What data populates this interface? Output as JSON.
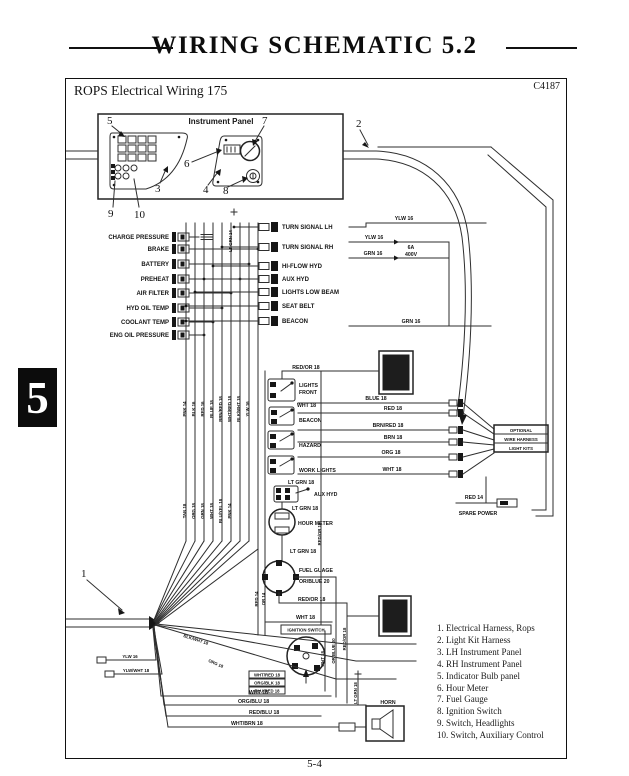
{
  "page": {
    "title": "WIRING SCHEMATIC 5.2",
    "chapter_tab": "5",
    "page_number": "5-4"
  },
  "header": {
    "subtitle": "ROPS Electrical Wiring 175",
    "code": "C4187"
  },
  "instrument_panel": {
    "label": "Instrument Panel"
  },
  "callouts": {
    "n1": "1",
    "n2": "2",
    "n3": "3",
    "n4": "4",
    "n5": "5",
    "n6": "6",
    "n7": "7",
    "n8": "8",
    "n9": "9",
    "n10": "10"
  },
  "indicators": [
    "CHARGE PRESSURE",
    "BRAKE",
    "BATTERY",
    "PREHEAT",
    "AIR FILTER",
    "HYD OIL TEMP",
    "COOLANT TEMP",
    "ENG OIL PRESSURE"
  ],
  "outputs": [
    "TURN SIGNAL LH",
    "TURN SIGNAL RH",
    "HI-FLOW HYD",
    "AUX HYD",
    "LIGHTS LOW BEAM",
    "SEAT BELT",
    "BEACON"
  ],
  "switches": {
    "lights1": "LIGHTS",
    "lights2": "FRONT",
    "beacon": "BEACON",
    "hazard": "HAZARD",
    "work_lights": "WORK LIGHTS",
    "aux_hyd": "AUX HYD"
  },
  "components": {
    "hour_meter": "HOUR METER",
    "fuel_gauge": "FUEL GUAGE",
    "ignition_switch": "IGNITION SWITCH",
    "horn": "HORN",
    "spare_power": "SPARE POWER",
    "fuse1": "6A",
    "fuse2": "400V",
    "optional1": "OPTIONAL",
    "optional2": "WIRE HARNESS",
    "optional3": "LIGHT KITS"
  },
  "wires": {
    "ylw16a": "YLW 16",
    "ylw16b": "YLW 16",
    "grn16a": "GRN 16",
    "grn16b": "GRN 16",
    "ltgrn14": "LT GRN 14",
    "redor18a": "RED/OR 18",
    "wht18a": "WHT 18",
    "blue18": "BLUE 18",
    "red18": "RED 18",
    "brnred18": "BRN/RED 18",
    "brn18": "BRN 18",
    "org18a": "ORG 18",
    "wht18b": "WHT 18",
    "ltgrn18a": "LT GRN 18",
    "ltgrn18b": "LT GRN 18",
    "ltgrn18c": "LT GRN 18",
    "orblue20a": "OR/BLUE 20",
    "redor18b": "RED/OR 18",
    "wht18c": "WHT 18",
    "redor18v": "RED/OR 18",
    "wht18v": "WHT 18",
    "orblue20v": "OR/BLUE 20",
    "redor18v2": "RED/OR 18",
    "ltgrn18v": "LT GRN 18",
    "red14a": "RED 14",
    "red14b": "RED 14",
    "or14": "OR 14",
    "wht18d": "WHT 18",
    "orgblu18": "ORG/BLU 18",
    "redblu18": "RED/BLU 18",
    "whtbrn18": "WHT/BRN 18",
    "ylw16c": "YLW 16",
    "ylwwht18": "YLW/WHT 18",
    "blkwht18": "BLK/WHT 18",
    "org18b": "ORG 18",
    "bundle_a": [
      "PNK 14",
      "BLK 16",
      "RED 16",
      "BLUE 18",
      "BRN/RED 18",
      "WHT/RED 18",
      "BLK/WHT 18",
      "YLW 16"
    ],
    "bundle_b": [
      "TAN 18",
      "ORG 18",
      "GRN 18",
      "WHT 18",
      "BLU/YEL 18",
      "PNK 14"
    ],
    "ign_stack": [
      "WHT/RED 18",
      "ORG/BLK 18",
      "BLU/RED 18"
    ]
  },
  "legend": {
    "items": [
      "1.  Electrical Harness,  Rops",
      "2.  Light Kit Harness",
      "3.  LH Instrument Panel",
      "4.  RH Instrument Panel",
      "5.  Indicator Bulb panel",
      "6.  Hour Meter",
      "7.  Fuel Gauge",
      "8.  Ignition Switch",
      "9.  Switch,  Headlights",
      "10.  Switch,  Auxiliary Control"
    ]
  }
}
